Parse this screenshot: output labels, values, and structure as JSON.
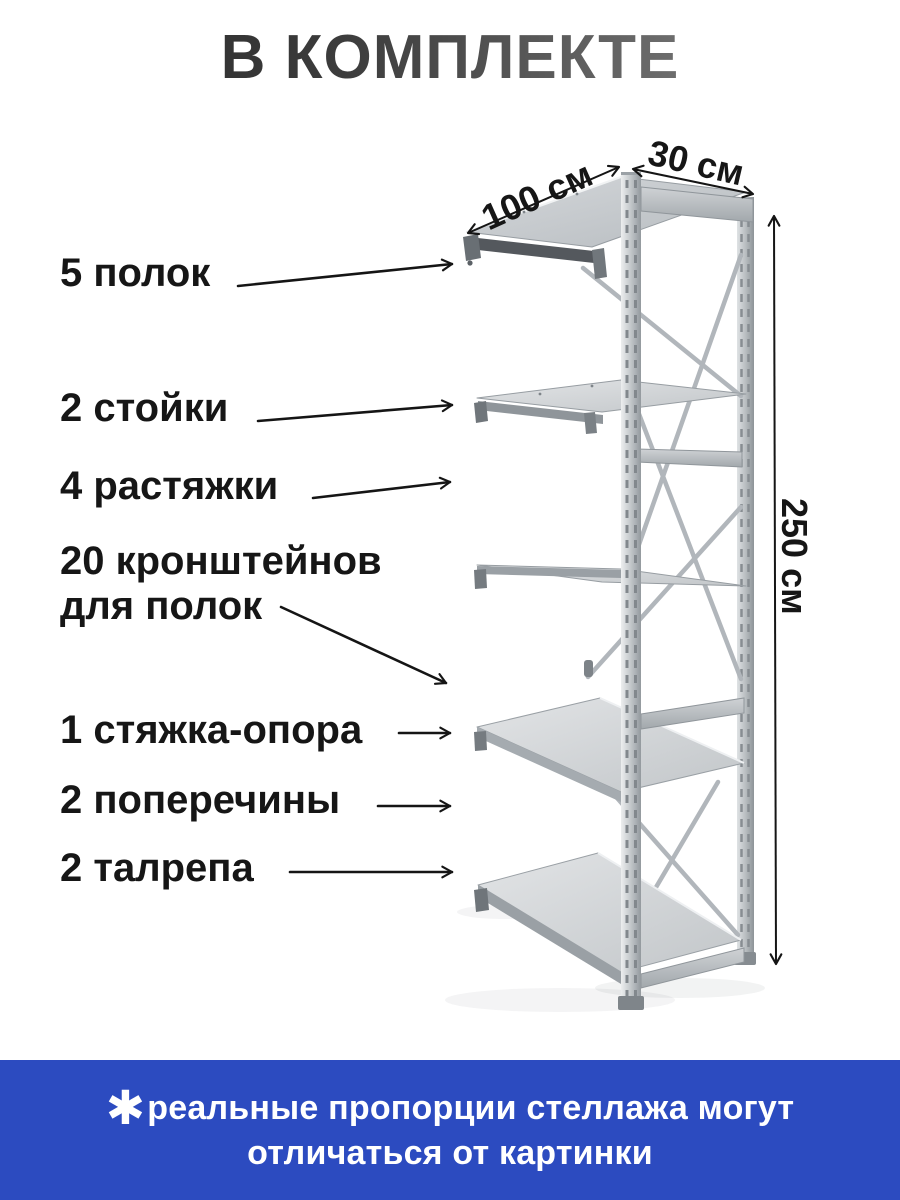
{
  "header": {
    "title": "В КОМПЛЕКТЕ"
  },
  "callouts": [
    {
      "text": "5 полок"
    },
    {
      "text": "2 стойки"
    },
    {
      "text": "4 растяжки"
    },
    {
      "text": "20 кронштейнов\nдля полок"
    },
    {
      "text": "1 стяжка-опора"
    },
    {
      "text": "2 поперечины"
    },
    {
      "text": "2 талрепа"
    }
  ],
  "dimensions": {
    "width": "100 см",
    "depth": "30 см",
    "height": "250 см"
  },
  "banner": {
    "asterisk_icon": "✱",
    "line1": "реальные пропорции стеллажа могут",
    "line2": "отличаться от картинки"
  },
  "colors": {
    "banner_blue": "#2c4bc0",
    "text_dark": "#161616",
    "title_gradient_start": "#262626",
    "title_gradient_end": "#8d8d8d",
    "metal_light": "#e4e6e8",
    "metal_mid": "#c3c7ca",
    "metal_dark": "#8f969b",
    "shelf_underside_dark": "#54585d"
  }
}
